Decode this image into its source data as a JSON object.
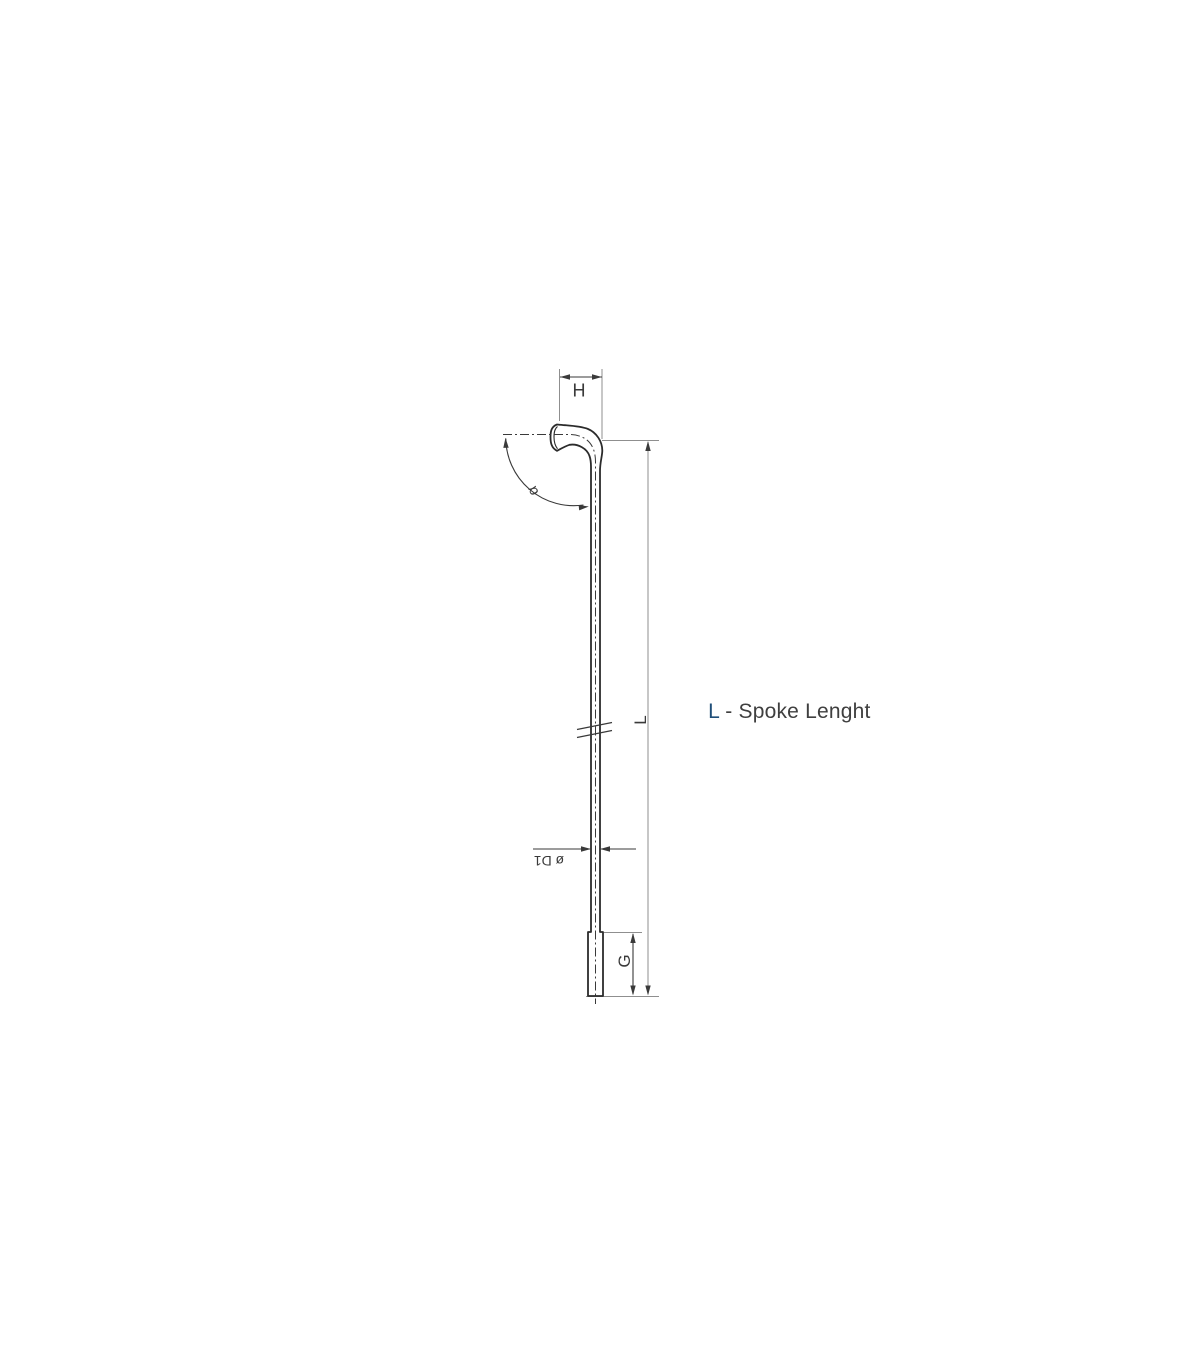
{
  "drawing": {
    "labels": {
      "head_width": "H",
      "bend_angle": "α",
      "spoke_length": "L",
      "shaft_diameter": "ø D1",
      "thread_length": "G"
    },
    "annotation": {
      "highlight": "L",
      "rest": " - Spoke Lenght"
    },
    "colors": {
      "outline": "#2b2b2b",
      "dimension_line": "#3a3a3a",
      "extension_line": "#8f8f8f",
      "text": "#3a3a3a",
      "highlight_text": "#1f4e79",
      "background": "#ffffff"
    }
  }
}
